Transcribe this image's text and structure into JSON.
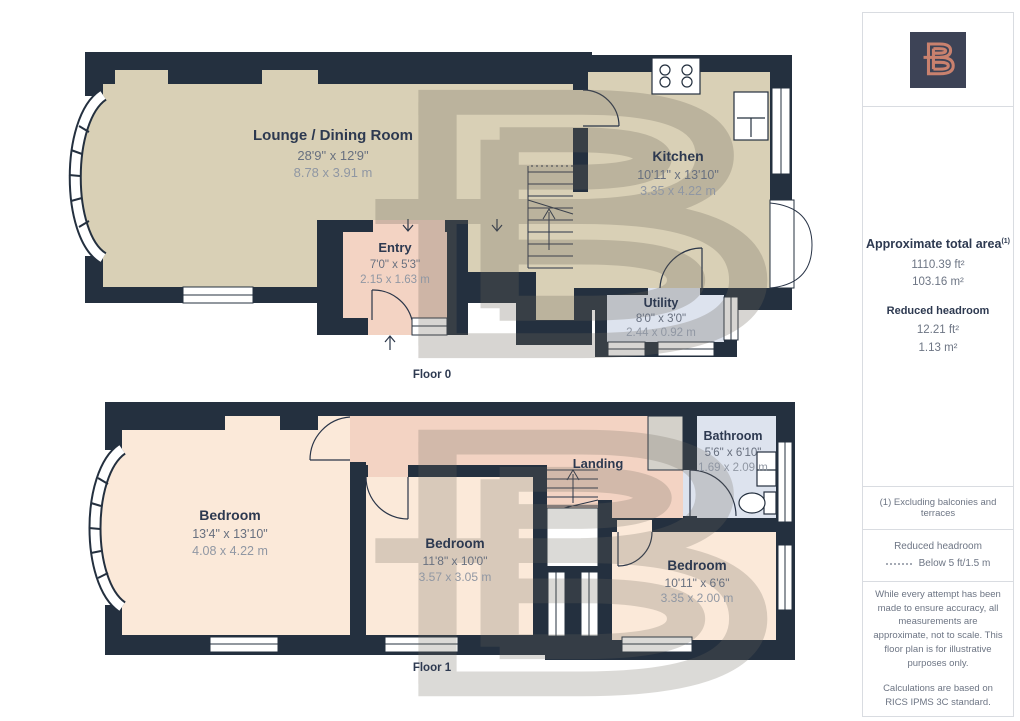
{
  "floor0": {
    "caption": "Floor 0",
    "rooms": {
      "lounge": {
        "name": "Lounge / Dining Room",
        "imperial": "28'9\" x 12'9\"",
        "metric": "8.78 x 3.91 m"
      },
      "entry": {
        "name": "Entry",
        "imperial": "7'0\" x 5'3\"",
        "metric": "2.15 x 1.63 m"
      },
      "kitchen": {
        "name": "Kitchen",
        "imperial": "10'11\" x 13'10\"",
        "metric": "3.35 x 4.22 m"
      },
      "utility": {
        "name": "Utility",
        "imperial": "8'0\" x 3'0\"",
        "metric": "2.44 x 0.92 m"
      }
    }
  },
  "floor1": {
    "caption": "Floor 1",
    "rooms": {
      "bedroom1": {
        "name": "Bedroom",
        "imperial": "13'4\" x 13'10\"",
        "metric": "4.08 x 4.22 m"
      },
      "bedroom2": {
        "name": "Bedroom",
        "imperial": "11'8\" x 10'0\"",
        "metric": "3.57 x 3.05 m"
      },
      "bedroom3": {
        "name": "Bedroom",
        "imperial": "10'11\" x 6'6\"",
        "metric": "3.35 x 2.00 m"
      },
      "landing": {
        "name": "Landing"
      },
      "bathroom": {
        "name": "Bathroom",
        "imperial": "5'6\" x 6'10\"",
        "metric": "1.69 x 2.09 m"
      }
    }
  },
  "sidebar": {
    "total_area": {
      "title": "Approximate total area",
      "marker": "(1)",
      "ft2": "1110.39 ft²",
      "m2": "103.16 m²"
    },
    "reduced_headroom": {
      "title": "Reduced headroom",
      "ft2": "12.21 ft²",
      "m2": "1.13 m²"
    },
    "footnote": "(1) Excluding balconies and terraces",
    "legend": {
      "title": "Reduced headroom",
      "value": "Below 5 ft/1.5 m"
    },
    "disclaimer1": "While every attempt has been made to ensure accuracy, all measurements are approximate, not to scale. This floor plan is for illustrative purposes only.",
    "disclaimer2": "Calculations are based on RICS IPMS 3C standard."
  },
  "colors": {
    "wall": "#24303f",
    "floor_tan": "#d9d0b6",
    "floor_salmon": "#f3d3c3",
    "floor_peach": "#fbe9d9",
    "floor_blue": "#dde3ee",
    "cupboard_gray": "#d4d1ca",
    "watermark": "#6e685c",
    "logo_bg": "#3d4356",
    "logo_coral": "#c9816e",
    "text_navy": "#2d3950"
  }
}
